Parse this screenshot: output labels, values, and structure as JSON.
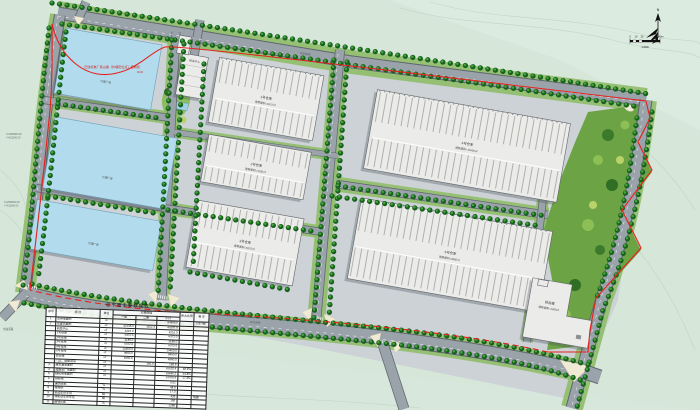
{
  "north": {
    "label": "N"
  },
  "scale_bar": {
    "labels": [
      "0",
      "10",
      "20",
      "40m"
    ],
    "ratio": "1:2000"
  },
  "annotations": {
    "red_note": "已建标准厂房山墙（外墙定位点）控制线",
    "red_note2": "45.00",
    "coord1a": "X=2568400.00",
    "coord1b": "Y=513200.00",
    "coord2a": "X=2568250.00",
    "coord2b": "Y=513180.00",
    "road_top": "规划道路",
    "road_bottom": "规划道路",
    "road_exit": "市政道路"
  },
  "buildings": {
    "rd_center": {
      "name": "研发中心",
      "l2": "建筑面积=4216㎡"
    },
    "wh1": {
      "name": "1号仓库",
      "l2": "建筑面积=6372㎡"
    },
    "wh2": {
      "name": "2号仓库",
      "l2": "建筑面积=3186㎡"
    },
    "wh3": {
      "name": "3号仓库",
      "l2": "建筑面积=6372㎡"
    },
    "wh4": {
      "name": "4号仓库",
      "l2": "建筑面积=10450㎡"
    },
    "wh5": {
      "name": "5号仓库",
      "l2": "建筑面积=9860㎡"
    },
    "complex": {
      "name": "综合楼",
      "l2": "建筑面积=4860㎡"
    },
    "blue1": {
      "name": "已建厂房"
    },
    "blue2": {
      "name": "已建厂房"
    },
    "blue3": {
      "name": "已建厂房"
    }
  },
  "colors": {
    "background": "#d6e7da",
    "road": "#9aa2aa",
    "tree": "#17611f",
    "blue_building": "#b2dcee",
    "warehouse": "#ebebe9",
    "boundary_red": "#e6221c",
    "green_belt": "#6ca344"
  },
  "table": {
    "title": "总平面主要数据表",
    "headers": {
      "top": [
        "序号",
        "项  目",
        "单位",
        "主要数据",
        "所占比例",
        "备  注"
      ],
      "sub": [
        "一期",
        "二期",
        "小计"
      ]
    },
    "rows": [
      [
        "1",
        "总用地面积",
        "㎡",
        "",
        "",
        "84866.0",
        "",
        "128.3亩"
      ],
      [
        "2",
        "总建筑面积",
        "㎡",
        "42145.6",
        "1152.3",
        "43297.9",
        "",
        ""
      ],
      [
        "",
        "研发中心",
        "㎡",
        "4216.0",
        "",
        "4216.0",
        "",
        ""
      ],
      [
        "",
        "1号仓库",
        "㎡",
        "6372.0",
        "",
        "6372.0",
        "",
        ""
      ],
      [
        "",
        "2号仓库",
        "㎡",
        "3186.0",
        "",
        "3186.0",
        "",
        ""
      ],
      [
        "",
        "3号仓库",
        "㎡",
        "6372.0",
        "",
        "6372.0",
        "",
        ""
      ],
      [
        "",
        "4号仓库",
        "㎡",
        "10450.0",
        "",
        "10450.0",
        "",
        ""
      ],
      [
        "",
        "5号仓库",
        "㎡",
        "9860.0",
        "",
        "9860.0",
        "",
        ""
      ],
      [
        "",
        "综合楼",
        "㎡",
        "4860.0",
        "",
        "4860.0",
        "",
        ""
      ],
      [
        "",
        "门卫、设备用房",
        "㎡",
        "",
        "185.6",
        "185.6",
        "",
        ""
      ],
      [
        "3",
        "建筑基底面积",
        "㎡",
        "",
        "",
        "41525.4",
        "48.9%",
        ""
      ],
      [
        "4",
        "道路及广场面积",
        "㎡",
        "",
        "",
        "28640.2",
        "33.8%",
        ""
      ],
      [
        "5",
        "绿化用地面积",
        "㎡",
        "",
        "",
        "14700.4",
        "17.3%",
        ""
      ],
      [
        "6",
        "容积率",
        "",
        "",
        "",
        "0.51",
        "",
        ""
      ],
      [
        "7",
        "建筑密度",
        "%",
        "",
        "",
        "48.9",
        "",
        ""
      ],
      [
        "8",
        "绿地率",
        "%",
        "",
        "",
        "17.3",
        "",
        ""
      ],
      [
        "9",
        "机动车停车位",
        "辆",
        "",
        "",
        "426",
        "",
        "地面"
      ],
      [
        "10",
        "非机动车停车位",
        "辆",
        "",
        "",
        "150",
        "",
        ""
      ],
      [
        "11",
        "围墙长度",
        "m",
        "",
        "",
        "1286",
        "",
        ""
      ]
    ]
  }
}
